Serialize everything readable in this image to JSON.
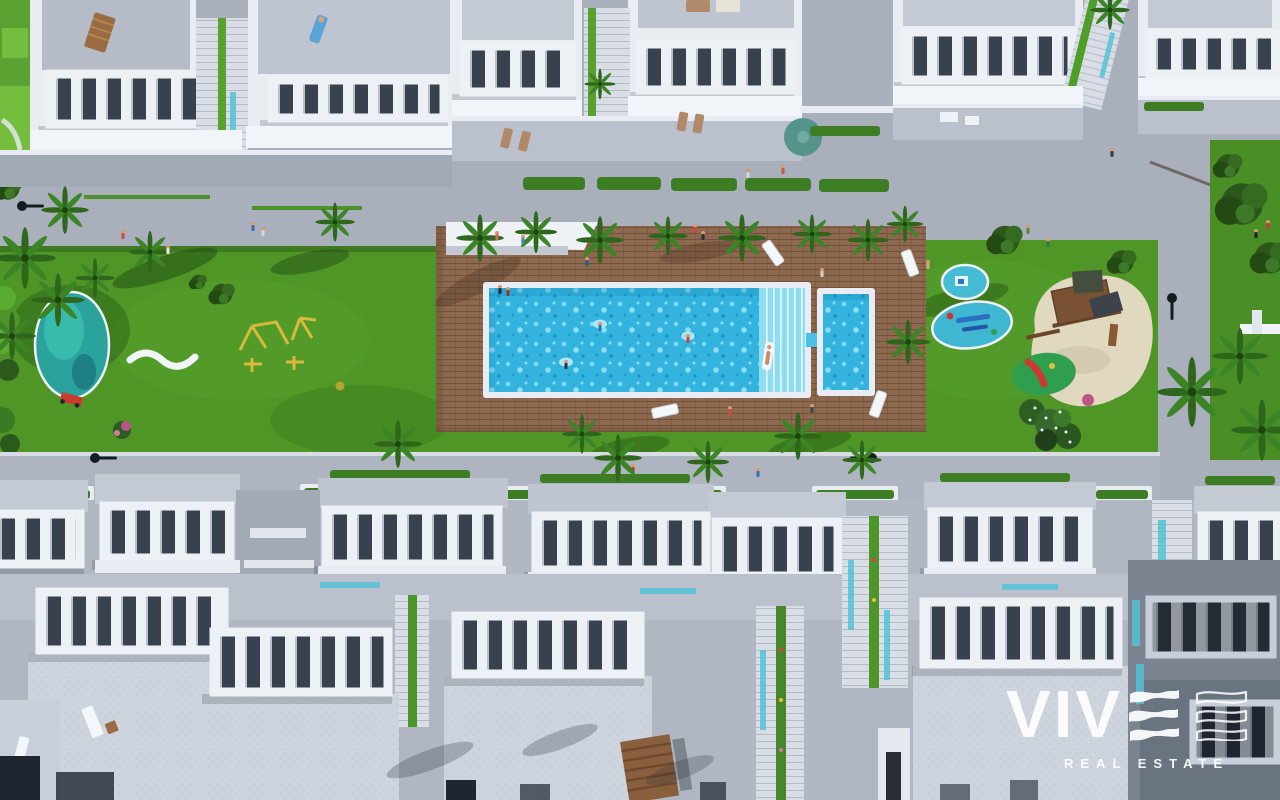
{
  "brand": {
    "name": "VIVE",
    "wordmark_prefix": "VIV",
    "tagline": "REAL ESTATE"
  },
  "scene": {
    "description": "Aerial top-down 3D render of a white residential complex: roof terraces with pergolas, a communal swimming pool on a timber sun deck, lawns, playgrounds, palm trees and walkways",
    "features": [
      "roof-terraces",
      "pergola-balustrades",
      "communal-pool",
      "kids-pool",
      "pool-steps",
      "timber-sun-deck",
      "sun-loungers",
      "swimmers",
      "lawn",
      "pond",
      "playground-equipment",
      "sand-play-area",
      "splash-pads",
      "slide-mound",
      "palm-trees",
      "hedge-planters",
      "street-lamps",
      "staircases",
      "pedestrian-walkways"
    ],
    "colors": {
      "grass": "#4f9627",
      "grass_shadow": "#1e4a12",
      "pool_water": "#33b4de",
      "pool_steps": "#8edcf0",
      "deck_wood": "#8d6950",
      "building_white": "#e9edf2",
      "roof_gray": "#bec5d0",
      "walkway_gray": "#a9b0bc",
      "pond_teal": "#2aa39c",
      "sand": "#e0d8bf",
      "hedge_green": "#3d7d24",
      "logo_white": "#ffffff"
    }
  }
}
